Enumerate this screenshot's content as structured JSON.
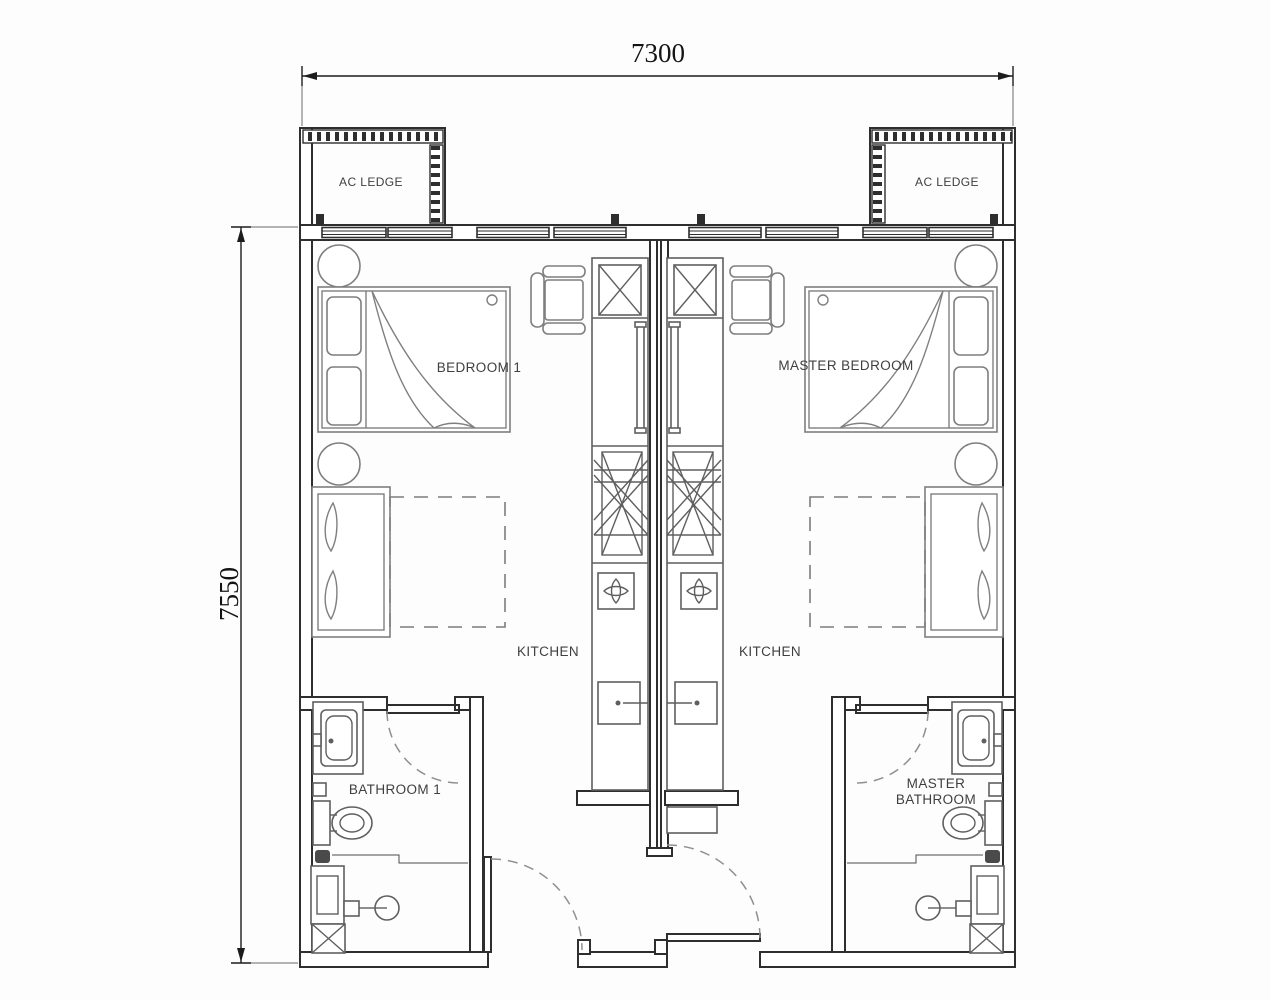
{
  "plan": {
    "type": "apartment-floor-plan",
    "dimensions": {
      "top": "7300",
      "left": "7550"
    },
    "labels": {
      "ac_ledge_left": "AC LEDGE",
      "ac_ledge_right": "AC LEDGE",
      "bedroom1": "BEDROOM 1",
      "master_bedroom": "MASTER BEDROOM",
      "kitchen_left": "KITCHEN",
      "kitchen_right": "KITCHEN",
      "bathroom1": "BATHROOM 1",
      "master_bathroom_line1": "MASTER",
      "master_bathroom_line2": "BATHROOM"
    },
    "colors": {
      "background": "#fdfdfd",
      "wall_line": "#2e2e2e",
      "furniture_line": "#7f7f7f",
      "fixture_line": "#5f5f5f",
      "text": "#3f3f3f",
      "dimension_text": "#141414"
    }
  }
}
